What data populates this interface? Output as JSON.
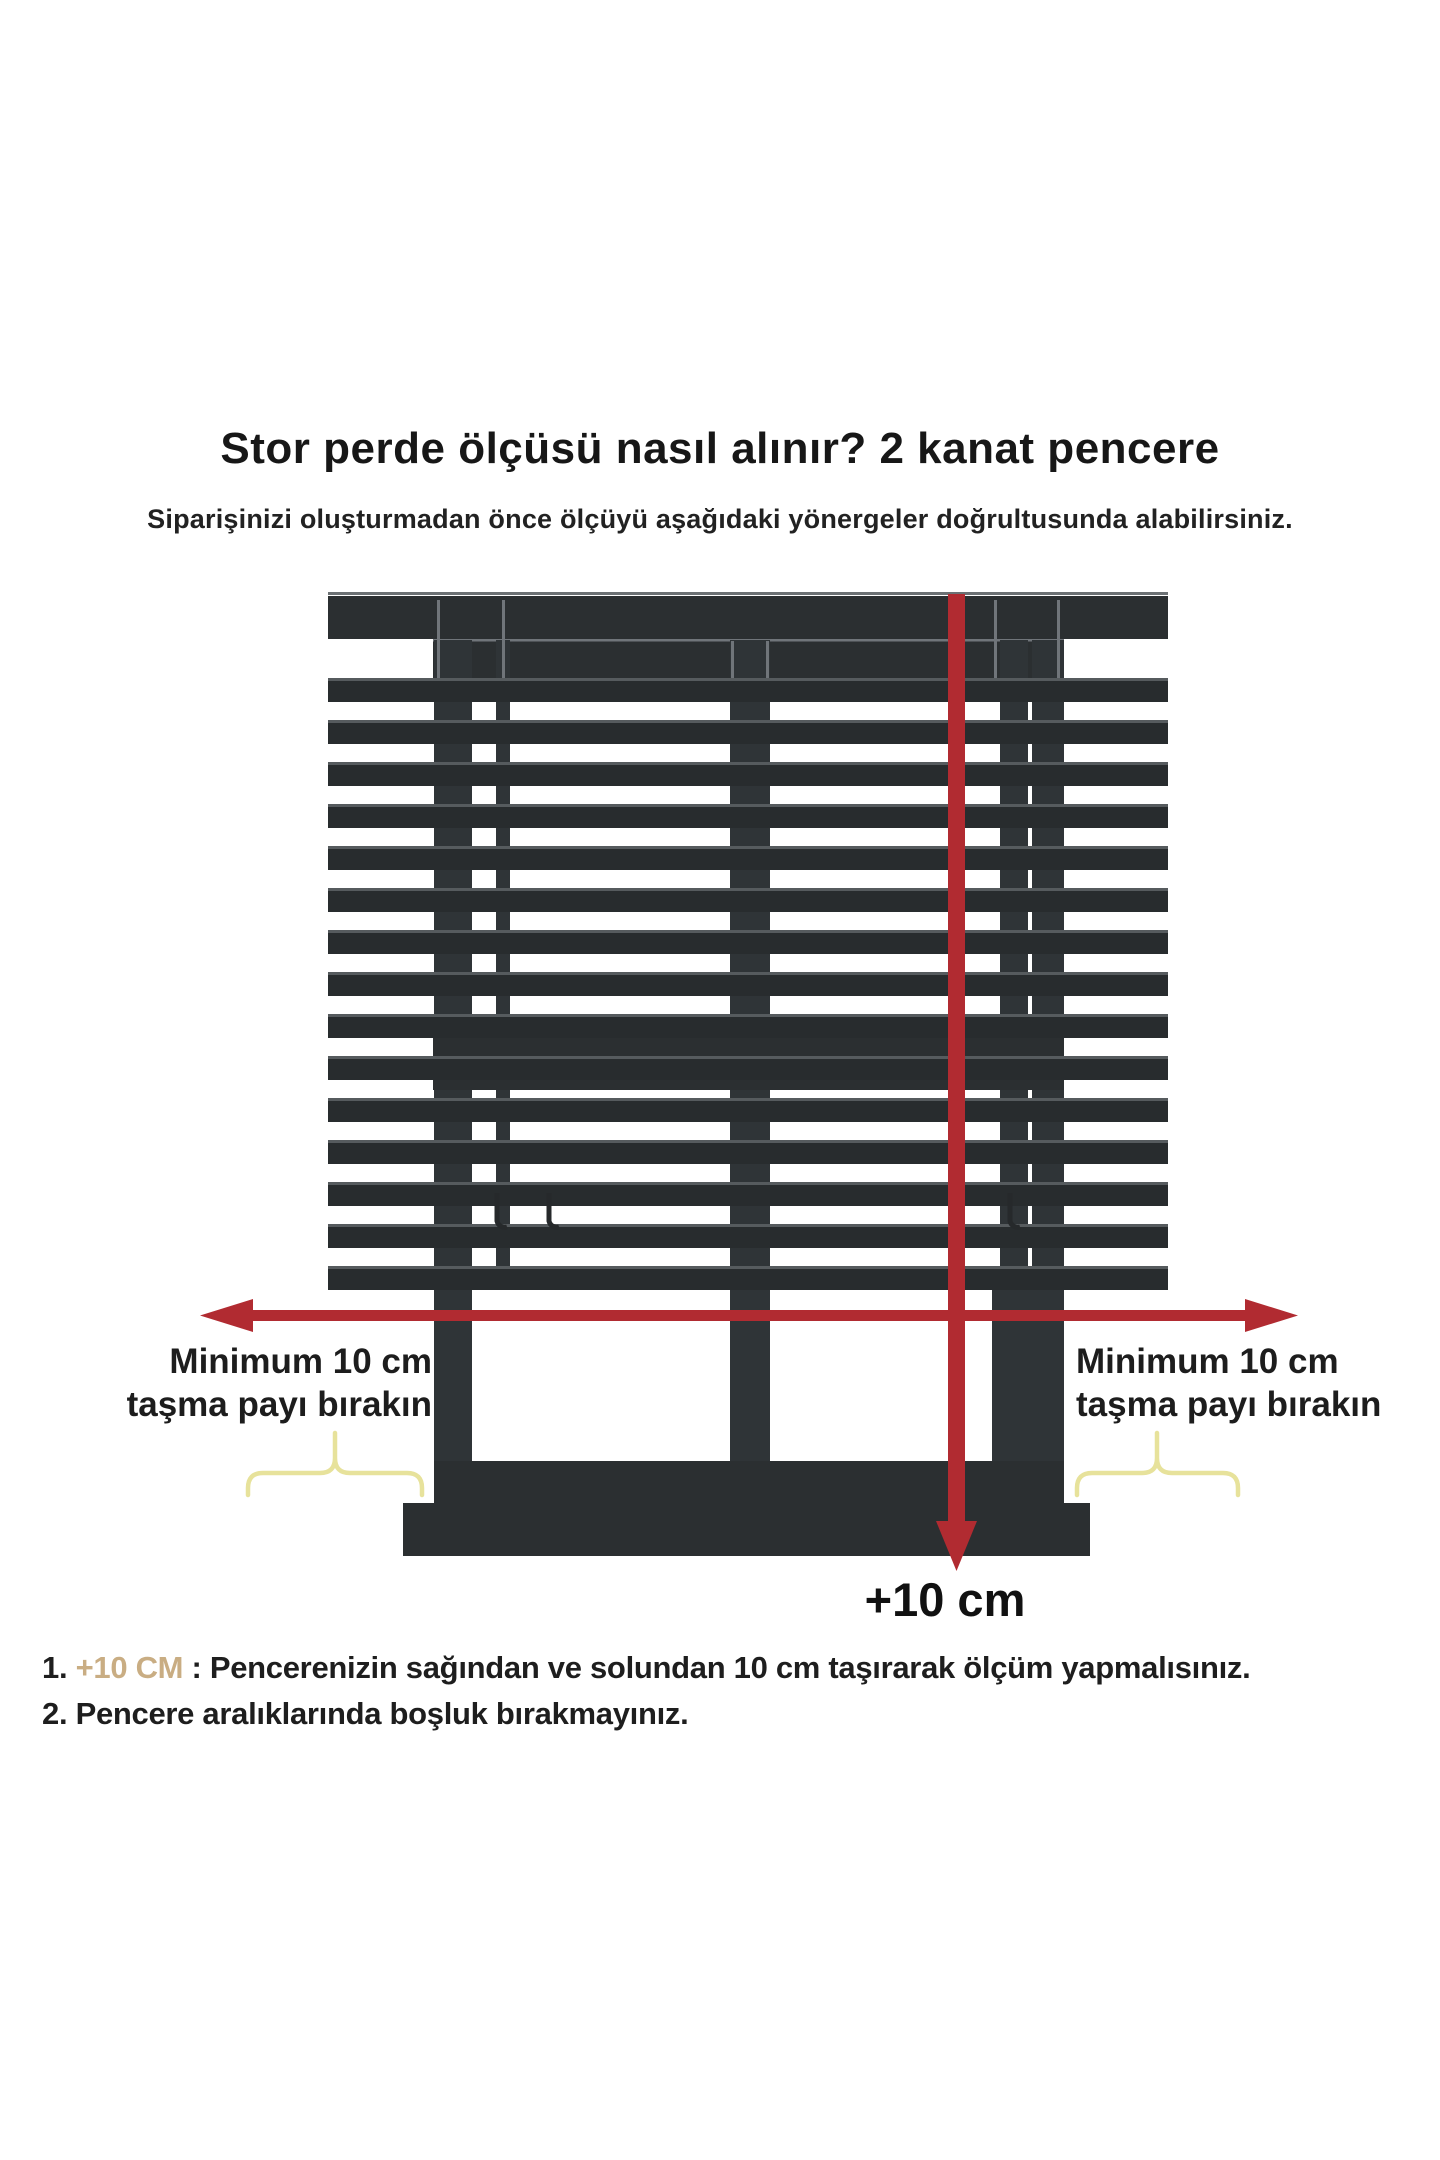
{
  "header": {
    "title": "Stor perde ölçüsü nasıl alınır? 2 kanat pencere",
    "subtitle": "Siparişinizi oluşturmadan önce ölçüyü aşağıdaki yönergeler doğrultusunda alabilirsiniz."
  },
  "diagram": {
    "left_label": {
      "line1": "Minimum 10 cm",
      "line2": "taşma payı bırakın"
    },
    "right_label": {
      "line1": "Minimum 10 cm",
      "line2": "taşma payı bırakın"
    },
    "bottom_arrow_label": "+10 cm",
    "colors": {
      "arrow_red": "#b12b31",
      "blind_dark": "#2b2f31",
      "slat_dark": "#282c2e",
      "brace_yellow": "#e7e29b",
      "highlight_tan": "#c9ad83"
    }
  },
  "instructions": {
    "item1": {
      "number": "1.",
      "highlight": "+10 CM",
      "text": " : Pencerenizin sağından ve solundan 10 cm taşırarak ölçüm yapmalısınız."
    },
    "item2": {
      "number": "2.",
      "text": " Pencere aralıklarında boşluk bırakmayınız."
    }
  }
}
